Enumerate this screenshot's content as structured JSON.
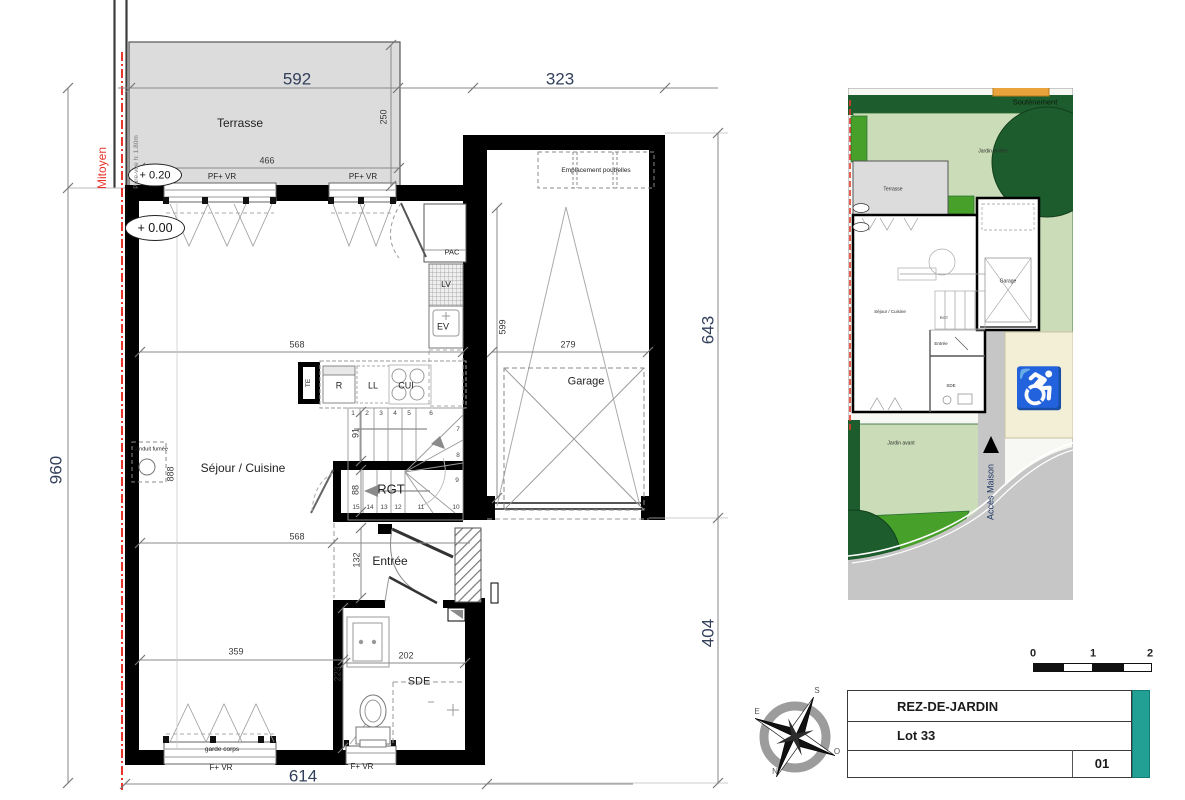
{
  "plan": {
    "rooms": {
      "terrasse": "Terrasse",
      "sejour": "Séjour / Cuisine",
      "garage": "Garage",
      "rgt": "RGT",
      "entree": "Entrée",
      "sde": "SDE"
    },
    "levels": {
      "terrace": "+ 0.20",
      "ground": "+ 0.00"
    },
    "annotations": {
      "mitoyen": "Mitoyen",
      "pare_vue": "Pare-vue h: 1.80m",
      "pf_vr_left": "PF+ VR",
      "pf_vr_right": "PF+ VR",
      "emplacement_poubelles": "Emplacement poubelles",
      "conduit_fumee": "Conduit fumée",
      "garde_corps": "garde corps",
      "f_vr_left": "F+ VR",
      "f_vr_sde": "F+ VR",
      "pac": "PAC",
      "lv": "LV",
      "ev": "EV",
      "te": "TE",
      "r": "R",
      "ll": "LL",
      "cui": "CUI"
    },
    "dims": {
      "terrace_width": "592",
      "terrace_inner": "466",
      "terrace_depth": "250",
      "garage_top": "323",
      "right_upper": "643",
      "right_lower": "404",
      "left_total": "960",
      "sejour_height": "888",
      "sejour_width_upper": "568",
      "sejour_width_lower": "568",
      "stair_width": "91",
      "rgt_width": "88",
      "entree_width": "132",
      "bottom_left": "359",
      "sde_width": "202",
      "sde_height": "223",
      "garage_width": "279",
      "garage_depth": "599",
      "total_width": "614"
    },
    "stairs": [
      "1",
      "2",
      "3",
      "4",
      "5",
      "6",
      "7",
      "8",
      "9",
      "10",
      "11",
      "12",
      "13",
      "14",
      "15"
    ]
  },
  "siteplan": {
    "soutenement": "Soutènement",
    "jardin_arriere": "Jardin arrière",
    "jardin_avant": "Jardin avant",
    "terrasse": "Terrasse",
    "sejour": "Séjour / Cuisine",
    "garage": "Garage",
    "rgt": "RGT",
    "entree": "Entrée",
    "sde": "SDE",
    "acces_maison": "Accès Maison",
    "handicap_icon": "♿"
  },
  "titleblock": {
    "title": "REZ-DE-JARDIN",
    "lot": "Lot 33",
    "sheet": "01"
  },
  "scalebar": {
    "ticks": [
      "0",
      "1",
      "2"
    ]
  },
  "compass": {
    "n": "N",
    "s": "S",
    "e": "E",
    "o": "O"
  },
  "colors": {
    "accent_teal": "#23a094",
    "wall_black": "#000000",
    "terrace_gray": "#dcdcdc",
    "boundary_red": "#e8362d",
    "garden_light": "#cbdcb8",
    "garden_dark": "#1d5c2c",
    "garden_medium": "#47a02a",
    "road_gray": "#c6c6c6",
    "parking_cream": "#f3eed6",
    "dim_blue": "#33405c"
  }
}
